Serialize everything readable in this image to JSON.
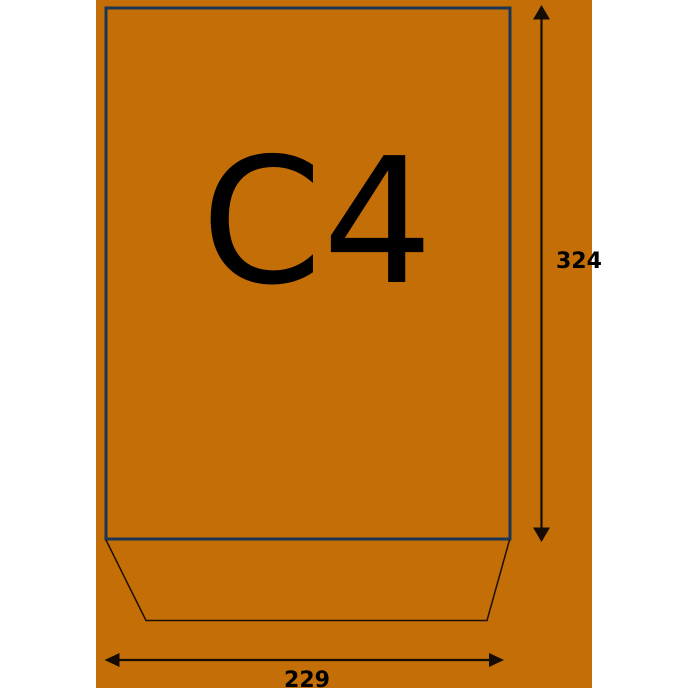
{
  "diagram": {
    "format_label": "C4",
    "height_label": "324",
    "width_label": "229"
  },
  "colors": {
    "page_background": "#ffffff",
    "diagram_background": "#c46e07",
    "envelope_outline": "#1b3655",
    "flap_line": "#1c0f03",
    "dimension_line": "#150d03",
    "label_text": "#000000"
  },
  "icons": {
    "height_arrow": "double-headed-vertical-arrow-icon",
    "width_arrow": "double-headed-horizontal-arrow-icon"
  }
}
